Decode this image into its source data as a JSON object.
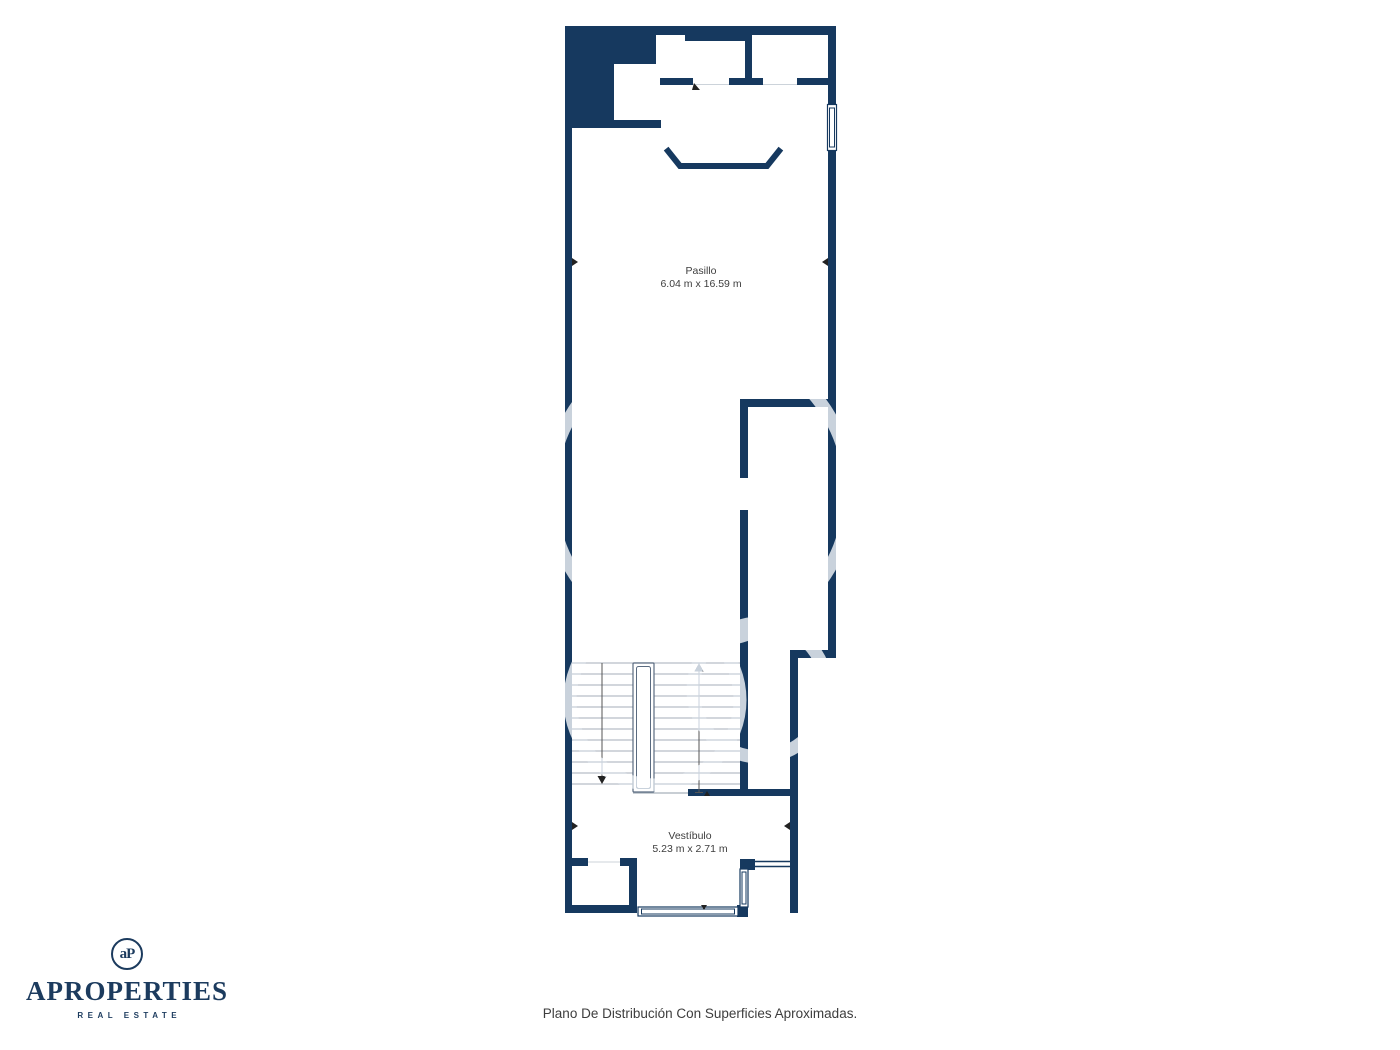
{
  "plan": {
    "rooms": [
      {
        "name": "Pasillo",
        "dimensions": "6.04 m x 16.59 m"
      },
      {
        "name": "Vestíbulo",
        "dimensions": "5.23 m x 2.71 m"
      }
    ],
    "caption": "Plano De Distribución Con Superficies Aproximadas."
  },
  "logo": {
    "monogram": "aP",
    "brand": "APROPERTIES",
    "tagline": "REAL ESTATE"
  },
  "colors": {
    "wall": "#16395F",
    "tread": "#b6bdc7",
    "faint": "#ccd3da",
    "text": "#3d3d3d",
    "logo": "#1C3B5E"
  }
}
